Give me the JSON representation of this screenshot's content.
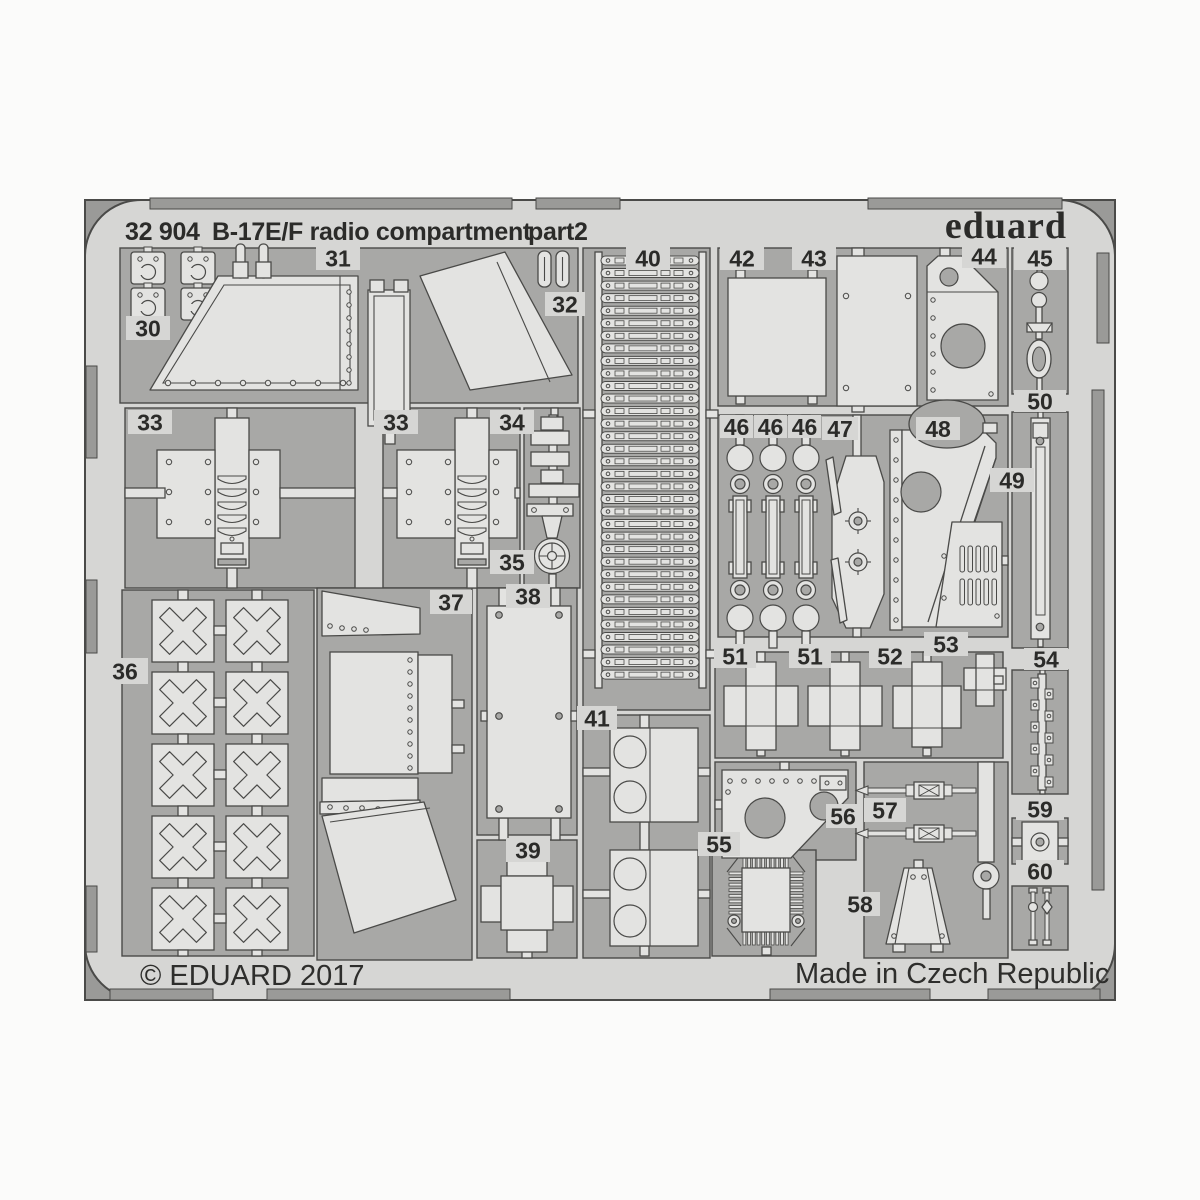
{
  "header": {
    "code": "32 904",
    "title": "B-17E/F radio compartment",
    "part": "part2",
    "brand": "eduard"
  },
  "footer": {
    "copyright": "© EDUARD 2017",
    "made_in": "Made in Czech Republic"
  },
  "colors": {
    "page": "#fbfbfa",
    "sheet": "#d6d6d4",
    "part": "#e3e3e1",
    "opening": "#a8a8a6",
    "corner": "#9a9a98",
    "outline": "#4a4a48",
    "text": "#2b2b29"
  },
  "parts": [
    {
      "id": "30",
      "label": "30"
    },
    {
      "id": "31",
      "label": "31"
    },
    {
      "id": "32",
      "label": "32"
    },
    {
      "id": "33a",
      "label": "33"
    },
    {
      "id": "33b",
      "label": "33"
    },
    {
      "id": "34",
      "label": "34"
    },
    {
      "id": "35",
      "label": "35"
    },
    {
      "id": "36",
      "label": "36"
    },
    {
      "id": "37",
      "label": "37"
    },
    {
      "id": "38",
      "label": "38"
    },
    {
      "id": "39",
      "label": "39"
    },
    {
      "id": "40",
      "label": "40"
    },
    {
      "id": "41",
      "label": "41"
    },
    {
      "id": "42",
      "label": "42"
    },
    {
      "id": "43",
      "label": "43"
    },
    {
      "id": "44",
      "label": "44"
    },
    {
      "id": "45",
      "label": "45"
    },
    {
      "id": "46a",
      "label": "46"
    },
    {
      "id": "46b",
      "label": "46"
    },
    {
      "id": "46c",
      "label": "46"
    },
    {
      "id": "47",
      "label": "47"
    },
    {
      "id": "48",
      "label": "48"
    },
    {
      "id": "49",
      "label": "49"
    },
    {
      "id": "50",
      "label": "50"
    },
    {
      "id": "51a",
      "label": "51"
    },
    {
      "id": "51b",
      "label": "51"
    },
    {
      "id": "52",
      "label": "52"
    },
    {
      "id": "53",
      "label": "53"
    },
    {
      "id": "54",
      "label": "54"
    },
    {
      "id": "55",
      "label": "55"
    },
    {
      "id": "56",
      "label": "56"
    },
    {
      "id": "57",
      "label": "57"
    },
    {
      "id": "58",
      "label": "58"
    },
    {
      "id": "59",
      "label": "59"
    },
    {
      "id": "60",
      "label": "60"
    }
  ]
}
